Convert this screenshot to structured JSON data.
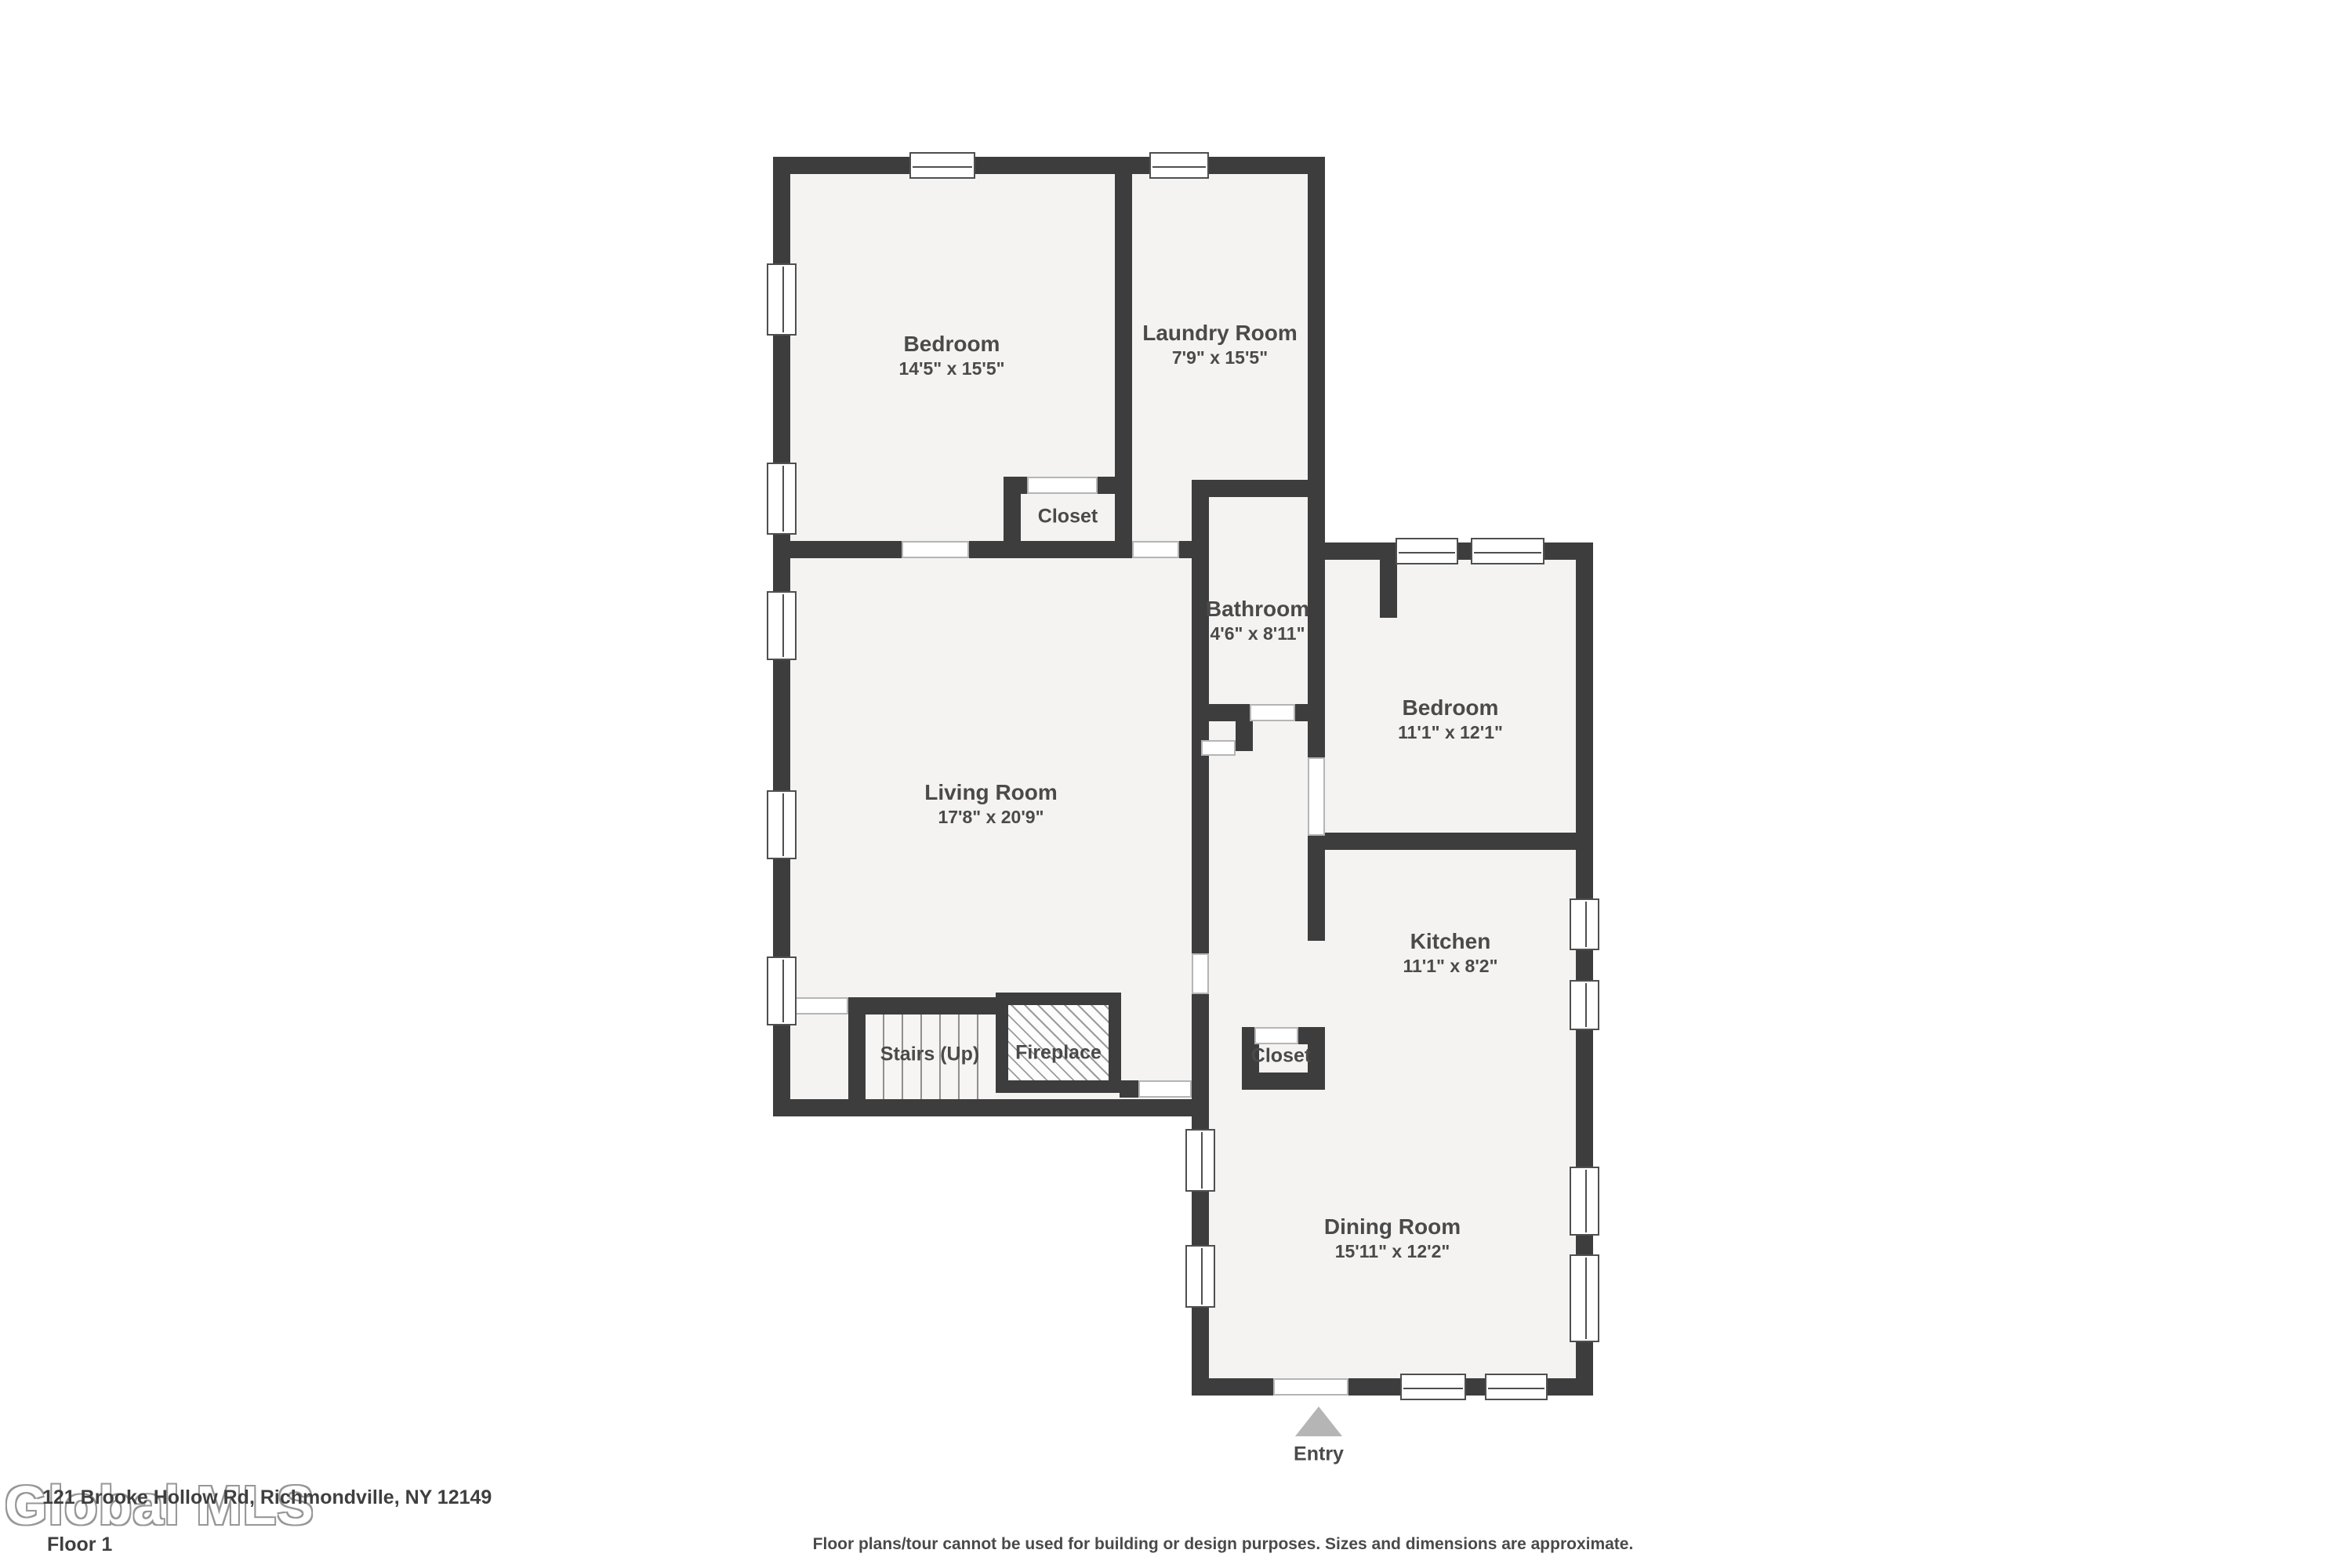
{
  "watermark": "Global MLS",
  "footer": {
    "address": "121 Brooke Hollow Rd, Richmondville, NY 12149",
    "floor_label": "Floor 1",
    "disclaimer": "Floor plans/tour cannot be used for building or design purposes. Sizes and dimensions are approximate."
  },
  "entry": {
    "label": "Entry"
  },
  "rooms": {
    "bedroom1": {
      "name": "Bedroom",
      "dims": "14'5\" x 15'5\""
    },
    "laundry": {
      "name": "Laundry Room",
      "dims": "7'9\" x 15'5\""
    },
    "closet1": {
      "name": "Closet"
    },
    "bathroom": {
      "name": "Bathroom",
      "dims": "4'6\" x 8'11\""
    },
    "bedroom2": {
      "name": "Bedroom",
      "dims": "11'1\" x 12'1\""
    },
    "living": {
      "name": "Living Room",
      "dims": "17'8\" x 20'9\""
    },
    "kitchen": {
      "name": "Kitchen",
      "dims": "11'1\" x 8'2\""
    },
    "closet2": {
      "name": "Closet"
    },
    "stairs": {
      "name": "Stairs (Up)"
    },
    "fireplace": {
      "name": "Fireplace"
    },
    "dining": {
      "name": "Dining Room",
      "dims": "15'11\" x 12'2\""
    }
  },
  "colors": {
    "wall": "#3d3d3d",
    "floor": "#f4f3f2",
    "text": "#4a4a4a",
    "arrow": "#b5b5b5"
  }
}
